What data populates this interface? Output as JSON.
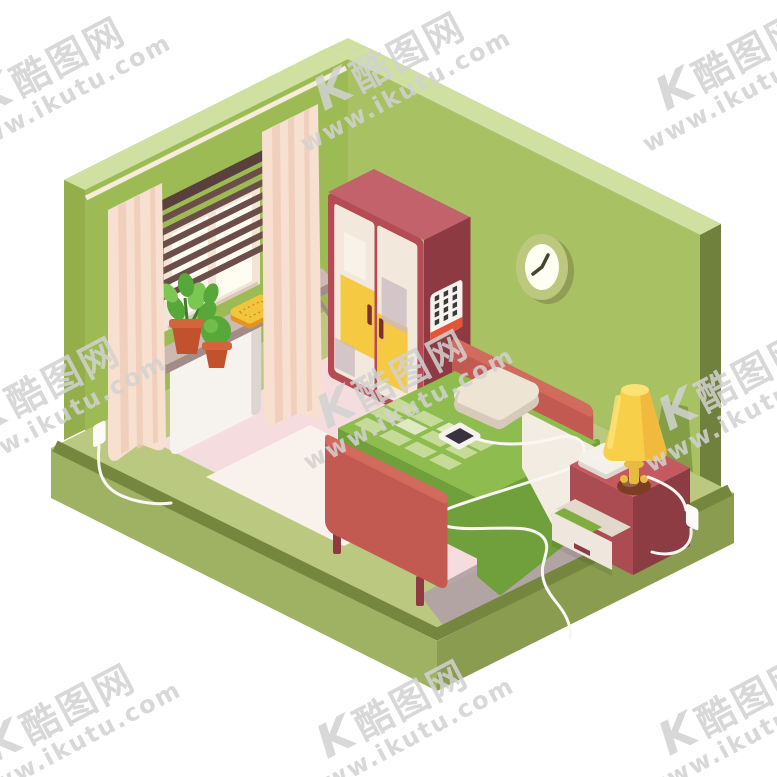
{
  "illustration": {
    "title": "Isometric bedroom interior illustration",
    "objects": [
      "green walls",
      "window with venetian blinds",
      "curtains",
      "windowsill plants",
      "yellow cushion",
      "radiator",
      "red wardrobe",
      "calendar",
      "wall clock",
      "bed with green quilt",
      "pillow",
      "smartphone with charging cable",
      "nightstand with open drawer",
      "book",
      "table lamp",
      "power outlets",
      "pink rug"
    ]
  },
  "watermark": {
    "logo": "K",
    "brand": "酷图网",
    "url": "www.ikutu.com",
    "color": "#d2d2d2",
    "tile_count": 9
  },
  "colors": {
    "background": "#ffffff",
    "wall_left": "#9dbb55",
    "wall_right": "#a8c163",
    "wall_top_edge": "#cfe0a0",
    "wall_outer_left": "#94ae4c",
    "wall_outer_right": "#6f813c",
    "slab_top": "#bac97f",
    "slab_rim": "#75863e",
    "slab_face_left": "#9fb264",
    "slab_face_right": "#8a9c50",
    "floor_pink": "#f4dcdf",
    "rug": "#f9f2ec",
    "shadow": "#b1a0a7",
    "curtain": "#f8e0d0",
    "curtain_fold": "#eecab8",
    "curtain_rod": "#f7ecd9",
    "window_frame": "#f3e5d5",
    "window_pane": "#fffdf2",
    "blinds": "#6b4d49",
    "blinds_bar": "#5a403d",
    "blind_cord": "#efe3d3",
    "sill_top": "#cdb8b3",
    "sill_side": "#a18c8a",
    "plant_green": "#57a839",
    "plant_green_light": "#7cc654",
    "pot": "#c2522e",
    "pot_rim": "#d3643c",
    "cushion_top": "#f2c53d",
    "cushion_side": "#e3931f",
    "radiator": "#f6f2ed",
    "radiator_side": "#ddd6d0",
    "wardrobe_front": "#b54c55",
    "wardrobe_side": "#8d3a43",
    "wardrobe_top": "#c4626b",
    "door_cream": "#f3e8dc",
    "door_yellow": "#f5c941",
    "handle": "#7a2f35",
    "patch_gray": "#c9bac3",
    "patch_light": "#f9f3ea",
    "calendar_white": "#f7f4ed",
    "calendar_red": "#e85238",
    "calendar_dots": "#3a3a3a",
    "clock_rim": "#bcc87d",
    "clock_rim_dark": "#8f9e52",
    "clock_face": "#fffef2",
    "clock_hands": "#44462f",
    "bed_red": "#c25a52",
    "bed_red_light": "#d26a5e",
    "bed_leg": "#8e3a40",
    "duvet": "#8fbc4f",
    "duvet_dark": "#6fa03c",
    "quilt_light": "#c6db97",
    "quilt_pale": "#dfeac2",
    "pillow": "#eee4d4",
    "pillow_side": "#d7cabb",
    "sheet": "#f2ece3",
    "phone_body": "#f5f2ed",
    "phone_screen": "#38313f",
    "nightstand_top": "#c45a60",
    "nightstand_front": "#ab4b52",
    "nightstand_side": "#8d3c44",
    "drawer_front": "#efe7dd",
    "book": "#7fae3e",
    "lamp_shade": "#f7cf49",
    "lamp_shade_deep": "#efa836",
    "lamp_glow": "#fbe275",
    "lamp_stem": "#e7bb3f",
    "lamp_base": "#7d3d22",
    "lamp_wall_shadow": "#7f9a42",
    "cable": "#faf7f2",
    "outlet": "#fcfbf8"
  }
}
